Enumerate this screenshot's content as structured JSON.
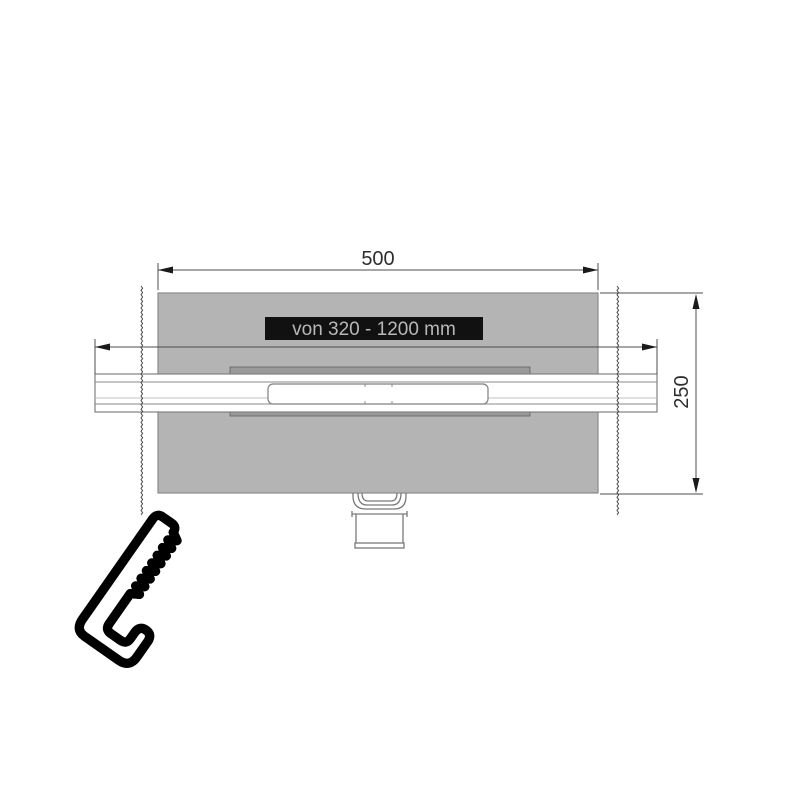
{
  "drawing": {
    "top_dimension": "500",
    "side_dimension": "250",
    "adjustable_length_label": "von 320 - 1200 mm"
  },
  "icons": {
    "saw_icon": "hacksaw-icon"
  },
  "colors": {
    "plate_fill": "#b4b4b4",
    "plate_stroke": "#8a8a8a",
    "recess_fill": "#9a9a9a",
    "channel_stroke": "#808080",
    "dimension_line": "#4d4d4d",
    "dimension_text": "#2e2e2e",
    "label_background": "#111111",
    "label_text": "#b8b8b8",
    "icon_color": "#000000"
  }
}
